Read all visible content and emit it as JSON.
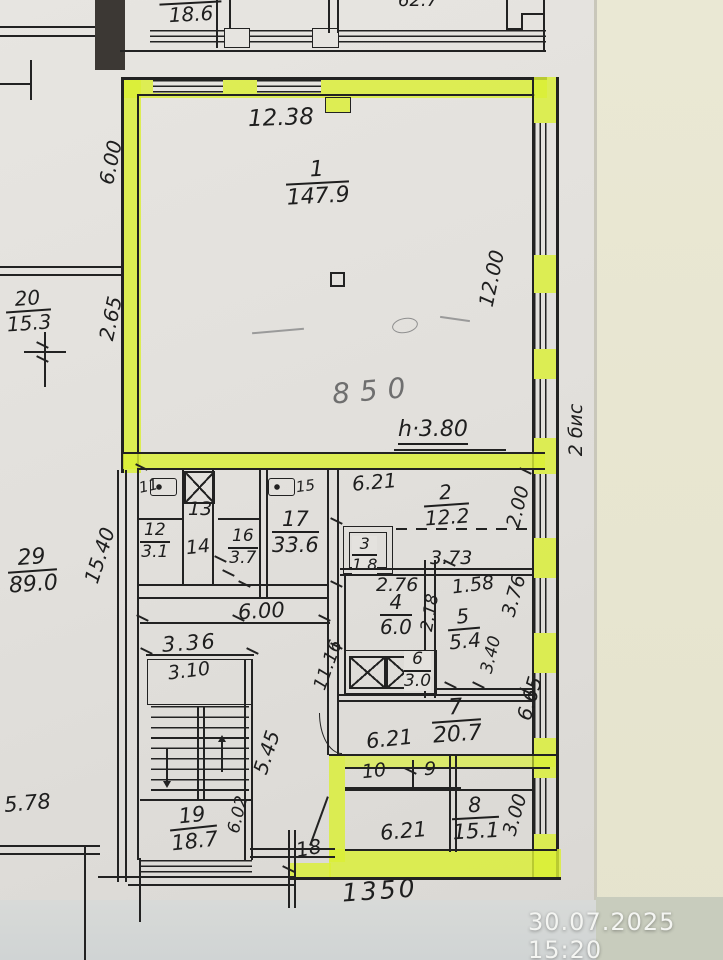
{
  "photo": {
    "timestamp": "30.07.2025  15:20"
  },
  "notes": {
    "height_note": "h·3.80",
    "handwritten": "850",
    "side_note": "2 бис"
  },
  "upper_rooms": {
    "left_area": "18.6",
    "right_area": "62.7"
  },
  "rooms": {
    "r1": {
      "num": "1",
      "area": "147.9"
    },
    "r2": {
      "num": "2",
      "area": "12.2"
    },
    "r3": {
      "num": "3",
      "area": "1.8"
    },
    "r4": {
      "num": "4",
      "area": "6.0"
    },
    "r5": {
      "num": "5",
      "area": "5.4"
    },
    "r6": {
      "num": "6",
      "area": "3.0"
    },
    "r7": {
      "num": "7",
      "area": "20.7"
    },
    "r8": {
      "num": "8",
      "area": "15.1"
    },
    "r9": {
      "num": "9"
    },
    "r10": {
      "num": "10"
    },
    "r11": {
      "num": "11"
    },
    "r12": {
      "num": "12",
      "area": "3.1"
    },
    "r13": {
      "num": "13"
    },
    "r14": {
      "num": "14"
    },
    "r15": {
      "num": "15"
    },
    "r16": {
      "num": "16",
      "area": "3.7"
    },
    "r17": {
      "num": "17",
      "area": "33.6"
    },
    "r18": {
      "num": "18"
    },
    "r19": {
      "num": "19",
      "area": "18.7"
    },
    "r20": {
      "num": "20",
      "area": "15.3"
    },
    "r29": {
      "num": "29",
      "area": "89.0"
    }
  },
  "dims": {
    "top_width": "12.38",
    "room1_height": "12.00",
    "left_top": "6.00",
    "left_mid": "2.65",
    "left_lower": "15.40",
    "left_bottom": "5.78",
    "room2_width": "6.21",
    "room2_depth": "2.00",
    "d276": "2.76",
    "d373": "3.73",
    "d158": "1.58",
    "d376": "3.76",
    "d218": "2.18",
    "d340": "3.40",
    "corridor_width": "6.00",
    "stair_width": "3.36",
    "stair_inner": "3.10",
    "stair_depth": "5.45",
    "corridor_len": "11.16",
    "room7_right": "6.65",
    "room7_width": "6.21",
    "room19_side": "6.02",
    "room8_width": "6.21",
    "room8_depth": "3.00",
    "bottom_total": "1350"
  }
}
